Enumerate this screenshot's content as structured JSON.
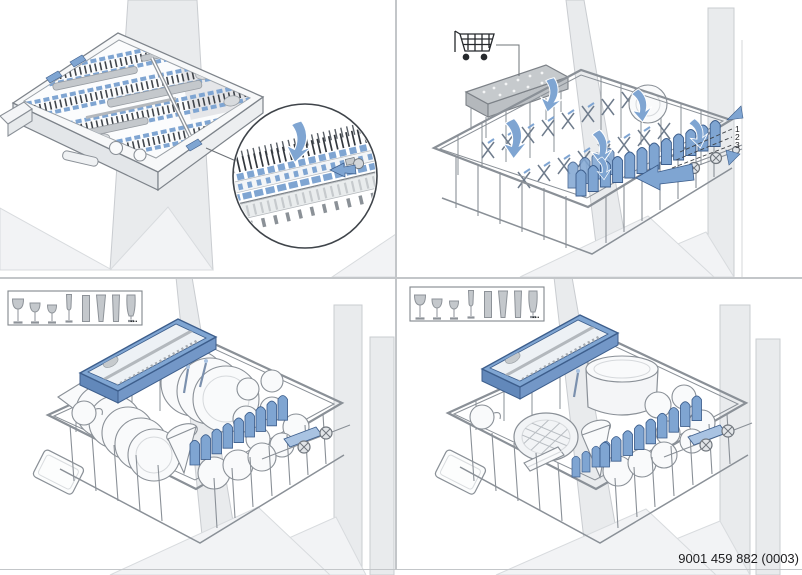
{
  "page": {
    "part_number": "9001 459 882 (0003)"
  },
  "colors": {
    "accent_blue": "#7fa5d2",
    "accent_blue_dark": "#3d5e8c",
    "accent_blue_soft": "#a9c3e2",
    "wire_gray": "#8a9097",
    "wall_gray": "#e9ebed",
    "item_gray": "#c4c8cc",
    "divider_gray": "#c3c6c9",
    "text_color": "#1d1d1f"
  },
  "level_indicator": {
    "levels": [
      "1",
      "2",
      "3"
    ]
  },
  "legend": {
    "ellipsis": "...",
    "glasses": [
      "wine-glass-large",
      "wine-glass-medium",
      "wine-glass-small",
      "champagne-flute",
      "straight-tumbler",
      "pilsner-glass",
      "tall-glass",
      "footed-glass"
    ]
  },
  "icons": {
    "shopping_cart": "shopping-cart-icon",
    "fold_arrow": "fold-down-arrow-icon",
    "push_arrow": "push-in-arrow-icon",
    "level_up": "raise-level-arrow-icon",
    "level_down": "lower-level-arrow-icon",
    "magnifier": "detail-zoom-circle"
  }
}
